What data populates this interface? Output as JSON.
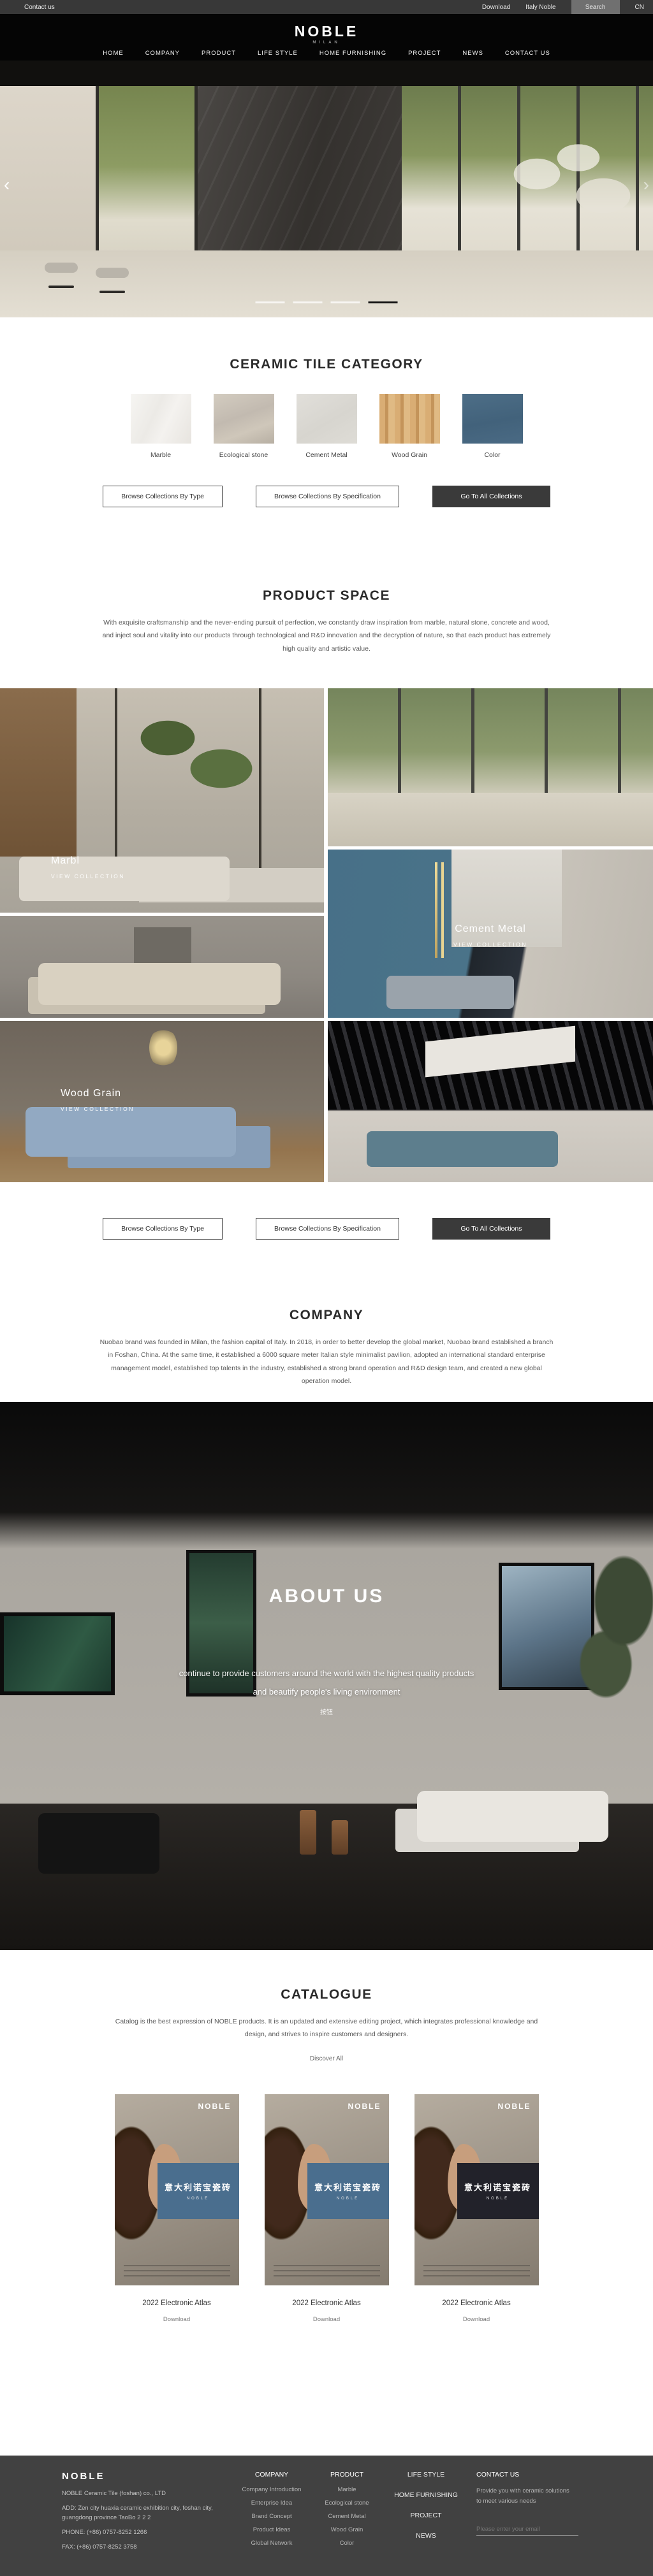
{
  "topbar": {
    "contact": "Contact us",
    "download": "Download",
    "italy_noble": "Italy Noble",
    "search": "Search",
    "lang": "CN"
  },
  "header": {
    "logo": "NOBLE",
    "logo_sub": "MILAN",
    "nav": [
      "HOME",
      "COMPANY",
      "PRODUCT",
      "LIFE STYLE",
      "HOME FURNISHING",
      "PROJECT",
      "NEWS",
      "CONTACT US"
    ]
  },
  "hero": {
    "prev": "‹",
    "next": "›",
    "slide_count": 4,
    "active_slide": 4
  },
  "category": {
    "title": "CERAMIC TILE CATEGORY",
    "items": [
      {
        "label": "Marble",
        "color": "#f3f1ee"
      },
      {
        "label": "Ecological stone",
        "color": "#c9c1b5"
      },
      {
        "label": "Cement Metal",
        "color": "#dddbd5"
      },
      {
        "label": "Wood Grain",
        "color": "#cfa263"
      },
      {
        "label": "Color",
        "color": "#476983"
      }
    ]
  },
  "collection_buttons": {
    "by_type": "Browse Collections By Type",
    "by_spec": "Browse Collections By Specification",
    "all": "Go To All Collections"
  },
  "product_space": {
    "title": "PRODUCT SPACE",
    "description": "With exquisite craftsmanship and the never-ending pursuit of perfection, we constantly draw inspiration from marble, natural stone, concrete and wood, and inject soul and vitality into our products through technological and R&D innovation and the decryption of nature, so that each product has extremely high quality and artistic value.",
    "tiles": [
      {
        "label": "Marbl",
        "cta": "VIEW COLLECTION"
      },
      {
        "label": "Cement Metal",
        "cta": "VIEW COLLECTION"
      },
      {
        "label": "Wood Grain",
        "cta": "VIEW COLLECTION"
      }
    ]
  },
  "company": {
    "title": "COMPANY",
    "description": "Nuobao brand was founded in Milan, the fashion capital of Italy. In 2018, in order to better develop the global market, Nuobao brand established a branch in Foshan, China. At the same time, it established a 6000 square meter Italian style minimalist pavilion, adopted an international standard enterprise management model, established top talents in the industry, established a strong brand operation and R&D design team, and created a new global operation model."
  },
  "about": {
    "title": "ABOUT US",
    "line1": "continue to provide customers around the world with the highest quality products",
    "line2": "and beautify people's living environment",
    "button_label": "按钮"
  },
  "catalogue": {
    "title": "CATALOGUE",
    "description": "Catalog is the best expression of NOBLE products. It is an updated and extensive editing project, which integrates professional knowledge and design, and strives to inspire customers and designers.",
    "discover": "Discover All",
    "poster_brand": "NOBLE",
    "poster_text": "意大利诺宝瓷砖",
    "items": [
      {
        "title": "2022 Electronic Atlas",
        "download": "Download",
        "panel_color": "#4a6e8e"
      },
      {
        "title": "2022 Electronic Atlas",
        "download": "Download",
        "panel_color": "#4a6e8e"
      },
      {
        "title": "2022 Electronic Atlas",
        "download": "Download",
        "panel_color": "#22222a"
      }
    ]
  },
  "footer": {
    "logo": "NOBLE",
    "company_name": "NOBLE Ceramic Tile (foshan) co., LTD",
    "address": "ADD:  Zen city huaxia ceramic exhibition city, foshan city, guangdong province TaoBo 2 2 2",
    "phone": "PHONE:   (+86)  0757-8252 1266",
    "fax": "FAX:   (+86)  0757-8252 3758",
    "columns": [
      {
        "header": "COMPANY",
        "items": [
          "Company Introduction",
          "Enterprise Idea",
          "Brand Concept",
          "Product Ideas",
          "Global Network"
        ]
      },
      {
        "header": "PRODUCT",
        "items": [
          "Marble",
          "Ecological stone",
          "Cement Metal",
          "Wood Grain",
          "Color"
        ]
      }
    ],
    "nav_links": [
      "LIFE STYLE",
      "HOME FURNISHING",
      "PROJECT",
      "NEWS"
    ],
    "contact": {
      "header": "CONTACT US",
      "text": "Provide you with ceramic solutions to meet various needs",
      "email_placeholder": "Please enter your email"
    }
  }
}
